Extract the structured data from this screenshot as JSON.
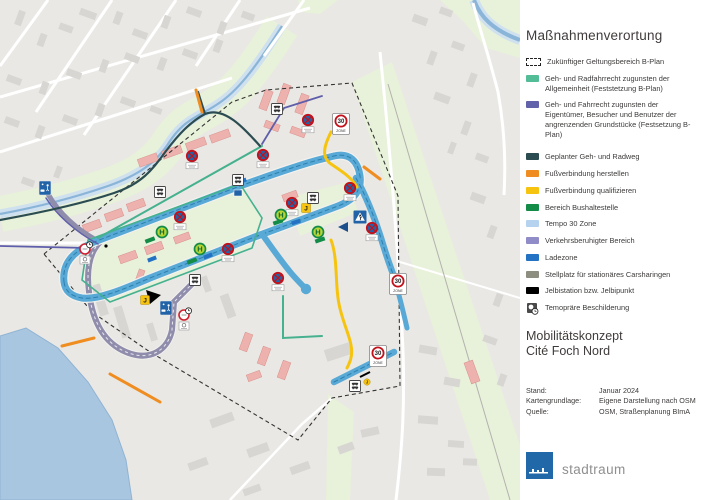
{
  "legend": {
    "title": "Maßnahmenverortung",
    "items": [
      {
        "label": "Zukünftiger Geltungsbereich B-Plan",
        "swatch": "dashed-outline",
        "color": "#ffffff"
      },
      {
        "label": "Geh- und Radfahrrecht zugunsten der Allgemeinheit (Feststetzung B-Plan)",
        "swatch": "fill",
        "color": "#53bd97"
      },
      {
        "label": "Geh- und Fahrrecht zugunsten der Eigentümer, Besucher und Benutzer der angrenzenden Grundstücke (Festsetzung B-Plan)",
        "swatch": "fill",
        "color": "#6262ab"
      },
      {
        "label": "Geplanter Geh- und Radweg",
        "swatch": "fill",
        "color": "#2b4d52",
        "gap_before": true
      },
      {
        "label": "Fußverbindung herstellen",
        "swatch": "fill",
        "color": "#ef8d21"
      },
      {
        "label": "Fußverbindung qualifizieren",
        "swatch": "fill",
        "color": "#f6c40f"
      },
      {
        "label": "Bereich Bushaltestelle",
        "swatch": "fill",
        "color": "#128c46"
      },
      {
        "label": "Tempo 30 Zone",
        "swatch": "fill",
        "color": "#b5d2ee"
      },
      {
        "label": "Verkehrsberuhigter Bereich",
        "swatch": "fill",
        "color": "#8f8cc8"
      },
      {
        "label": "Ladezone",
        "swatch": "fill",
        "color": "#2472c4"
      },
      {
        "label": "Stellplatz für stationäres Carsharingen",
        "swatch": "fill",
        "color": "#8d8d80"
      },
      {
        "label": "Jelbistation bzw. Jelbipunkt",
        "swatch": "fill",
        "color": "#000000"
      },
      {
        "label": "Temopräre Beschilderung",
        "swatch": "sign-clock",
        "color": "#4a4a4a"
      }
    ]
  },
  "titleblock": {
    "line1": "Mobilitätskonzept",
    "line2": "Cité Foch Nord"
  },
  "meta": {
    "rows": [
      {
        "label": "Stand:",
        "value": "Januar 2024"
      },
      {
        "label": "Kartengrundlage:",
        "value": "Eigene Darstellung nach OSM"
      },
      {
        "label": "Quelle:",
        "value": "OSM, Straßenplanung BImA"
      }
    ]
  },
  "logo": {
    "text": "stadtraum",
    "color": "#2068a8"
  },
  "map": {
    "colors": {
      "road_tempo30": "#58a9d6",
      "road_tempo30_dash": "#2d7fae",
      "traffic_calmed": "#8f8dab",
      "teal_right_of_way": "#45b18f",
      "purple_right_of_way": "#5f5eaa",
      "planned_path": "#2b4d52",
      "footpath_create": "#ef8d21",
      "footpath_upgrade": "#f6c40f",
      "bus_area": "#128c46",
      "loading_zone": "#2472c4",
      "water": "#a9c6e1",
      "green": "#e8f1d9"
    },
    "signs": {
      "no_stopping": {
        "positions": [
          [
            308,
            120
          ],
          [
            192,
            156
          ],
          [
            263,
            155
          ],
          [
            180,
            217
          ],
          [
            292,
            203
          ],
          [
            350,
            188
          ],
          [
            228,
            249
          ],
          [
            278,
            278
          ],
          [
            372,
            228
          ]
        ]
      },
      "zone30": {
        "number": "30",
        "zone_text": "ZONE",
        "positions": [
          [
            341,
            124
          ],
          [
            398,
            284
          ],
          [
            378,
            356
          ]
        ]
      },
      "bus_stop": {
        "letter": "H",
        "positions": [
          [
            162,
            232
          ],
          [
            200,
            249
          ],
          [
            281,
            215
          ],
          [
            318,
            232
          ]
        ]
      },
      "jelbi": {
        "letter": "J",
        "positions": [
          [
            145,
            300
          ],
          [
            306,
            208
          ]
        ],
        "small_positions": [
          [
            367,
            382
          ]
        ]
      },
      "pedestrian_crossing": {
        "positions": [
          [
            360,
            217
          ]
        ]
      },
      "play_street": {
        "positions": [
          [
            45,
            188
          ],
          [
            166,
            308
          ]
        ]
      },
      "temporary_sign": {
        "positions": [
          [
            85,
            249
          ],
          [
            184,
            315
          ]
        ]
      },
      "carsharing": {
        "positions": [
          [
            277,
            109
          ],
          [
            160,
            192
          ],
          [
            238,
            180
          ],
          [
            195,
            280
          ],
          [
            313,
            198
          ],
          [
            355,
            386
          ]
        ]
      }
    }
  }
}
